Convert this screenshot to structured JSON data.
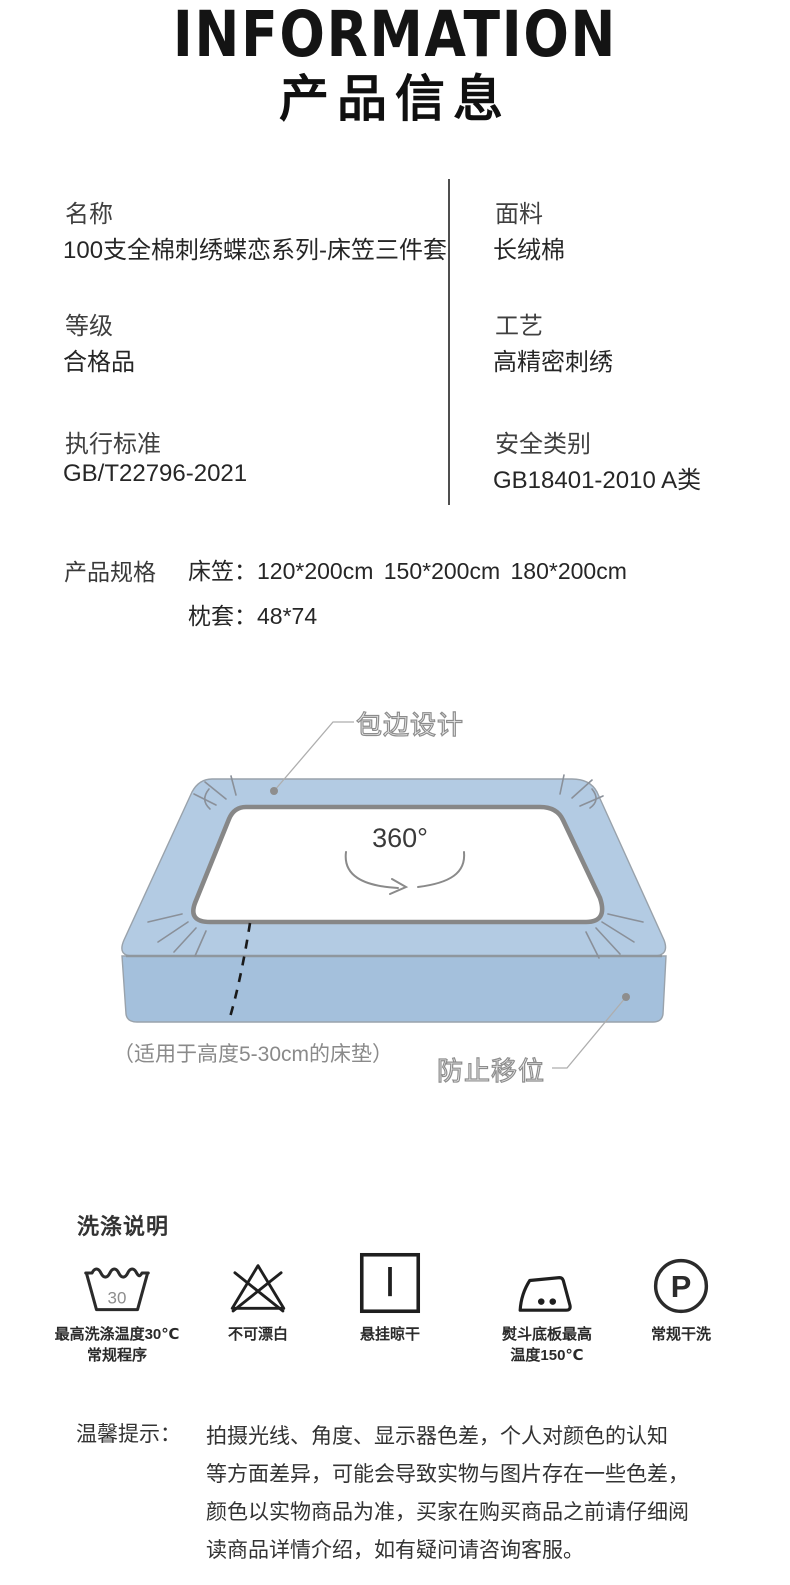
{
  "header": {
    "title_en": "INFORMATION",
    "title_zh": "产品信息"
  },
  "info_table": {
    "rows": [
      {
        "label": "名称",
        "value": "100支全棉刺绣蝶恋系列-床笠三件套"
      },
      {
        "label": "面料",
        "value": "长绒棉"
      },
      {
        "label": "等级",
        "value": "合格品"
      },
      {
        "label": "工艺",
        "value": "高精密刺绣"
      },
      {
        "label": "执行标准",
        "value": "GB/T22796-2021"
      },
      {
        "label": "安全类别",
        "value": "GB18401-2010 A类"
      }
    ]
  },
  "specs": {
    "label": "产品规格",
    "rows": [
      {
        "name": "床笠：",
        "value": "120*200cm 150*200cm 180*200cm"
      },
      {
        "name": "枕套：",
        "value": "48*74"
      }
    ]
  },
  "diagram": {
    "edge_label": "包边设计",
    "rotation_label": "360°",
    "fit_note": "（适用于高度5-30cm的床垫）",
    "slip_label": "防止移位",
    "sheet_top_color": "#b3cbe3",
    "sheet_side_color": "#a4c0dc",
    "opening_border_color": "#878787"
  },
  "washing": {
    "title": "洗涤说明",
    "items": [
      {
        "icon": "wash-tub-30-icon",
        "glyph": "30",
        "lines": [
          "最高洗涤温度30℃",
          "常规程序"
        ]
      },
      {
        "icon": "no-bleach-icon",
        "lines": [
          "不可漂白"
        ]
      },
      {
        "icon": "hang-dry-icon",
        "lines": [
          "悬挂晾干"
        ]
      },
      {
        "icon": "iron-max-150-icon",
        "lines": [
          "熨斗底板最高",
          "温度150℃"
        ]
      },
      {
        "icon": "dry-clean-p-icon",
        "glyph": "P",
        "lines": [
          "常规干洗"
        ]
      }
    ]
  },
  "tips": {
    "label": "温馨提示：",
    "lines": [
      "拍摄光线、角度、显示器色差，个人对颜色的认知",
      "等方面差异，可能会导致实物与图片存在一些色差，",
      "颜色以实物商品为准，买家在购买商品之前请仔细阅",
      "读商品详情介绍，如有疑问请咨询客服。"
    ]
  }
}
